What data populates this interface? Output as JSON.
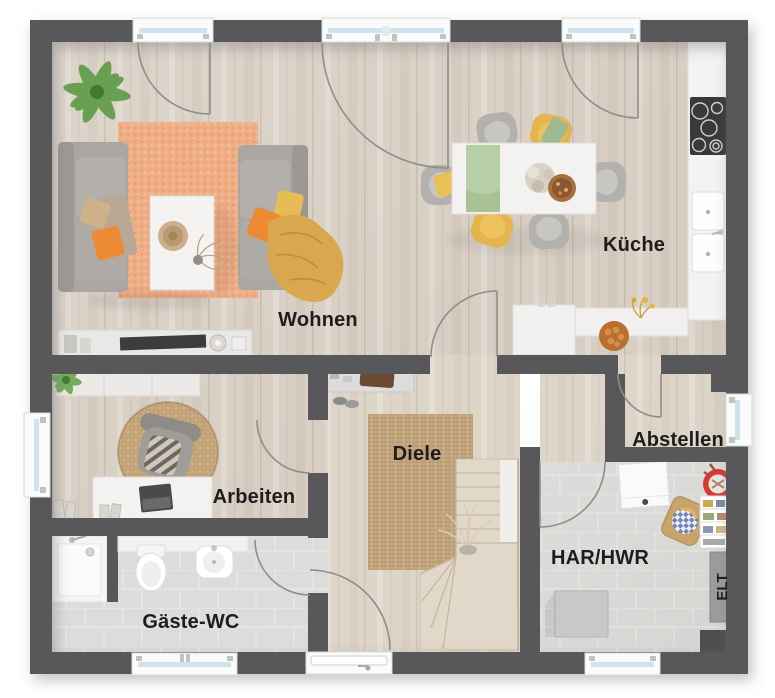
{
  "rooms": {
    "wohnen": "Wohnen",
    "kueche": "Küche",
    "arbeiten": "Arbeiten",
    "diele": "Diele",
    "abstellen": "Abstellen",
    "gaeste_wc": "Gäste-WC",
    "har_hwr": "HAR/HWR",
    "elt": "ELT"
  },
  "palette": {
    "wall": "#58585a",
    "wood_floor": "#d8cec3",
    "wood_floor_light": "#ded5c9",
    "tile_floor": "#dcdcda",
    "rug_wohnen": "#efae85",
    "rug_diele": "#c3a67e",
    "sofa_gray": "#aaa6a1",
    "accent_orange": "#ee8a33",
    "accent_yellow": "#e6bc55",
    "runner_green": "#b7cfa6",
    "white_furniture": "#f3f2f0",
    "window_glass": "#cfe3ee",
    "basket_red": "#d23b33",
    "plant_green": "#5d9a44",
    "label_text": "#1d1d1b"
  }
}
